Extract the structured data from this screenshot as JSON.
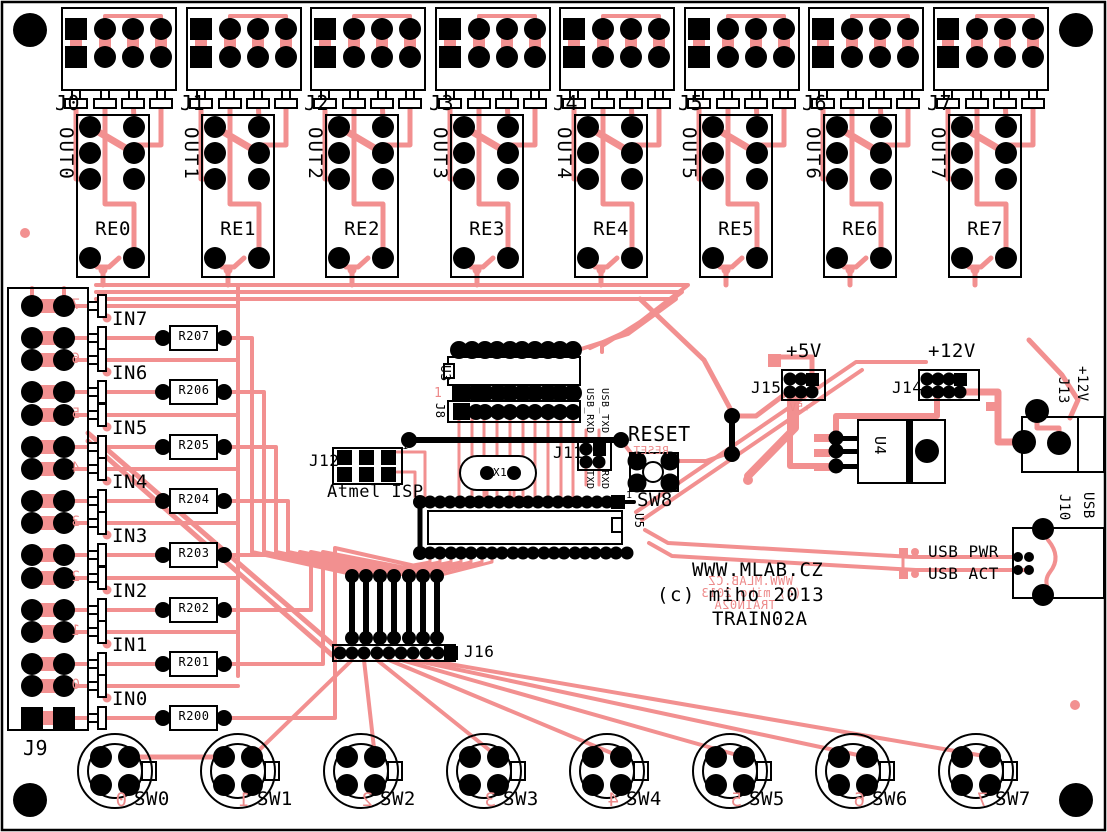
{
  "board": {
    "site": "WWW.MLAB.CZ",
    "copyright": "(c) miho 2013",
    "title": "TRAIN02A",
    "mirror_site": "WWW.MLAB.CZ",
    "mirror_copyright": "(c) miho 2013",
    "mirror_title": "TRAIN02A",
    "colors": {
      "trace_pink": "#F29090",
      "silkscreen_black": "#000000",
      "board_white": "#FFFFFF"
    }
  },
  "output_connectors": [
    {
      "label": "J0"
    },
    {
      "label": "J1"
    },
    {
      "label": "J2"
    },
    {
      "label": "J3"
    },
    {
      "label": "J4"
    },
    {
      "label": "J5"
    },
    {
      "label": "J6"
    },
    {
      "label": "J7"
    }
  ],
  "relays": [
    {
      "label": "RE0",
      "out": "OUT0"
    },
    {
      "label": "RE1",
      "out": "OUT1"
    },
    {
      "label": "RE2",
      "out": "OUT2"
    },
    {
      "label": "RE3",
      "out": "OUT3"
    },
    {
      "label": "RE4",
      "out": "OUT4"
    },
    {
      "label": "RE5",
      "out": "OUT5"
    },
    {
      "label": "RE6",
      "out": "OUT6"
    },
    {
      "label": "RE7",
      "out": "OUT7"
    }
  ],
  "inputs": [
    {
      "label": "IN7",
      "resistor": "R207",
      "pin": "7"
    },
    {
      "label": "IN6",
      "resistor": "R206",
      "pin": "6"
    },
    {
      "label": "IN5",
      "resistor": "R205",
      "pin": "5"
    },
    {
      "label": "IN4",
      "resistor": "R204",
      "pin": "4"
    },
    {
      "label": "IN3",
      "resistor": "R203",
      "pin": "3"
    },
    {
      "label": "IN2",
      "resistor": "R202",
      "pin": "2"
    },
    {
      "label": "IN1",
      "resistor": "R201",
      "pin": "1"
    },
    {
      "label": "IN0",
      "resistor": "R200",
      "pin": "0"
    }
  ],
  "input_connector": {
    "label": "J9"
  },
  "switches": [
    {
      "label": "SW0",
      "pin": "0"
    },
    {
      "label": "SW1",
      "pin": "1"
    },
    {
      "label": "SW2",
      "pin": "2"
    },
    {
      "label": "SW3",
      "pin": "3"
    },
    {
      "label": "SW4",
      "pin": "4"
    },
    {
      "label": "SW5",
      "pin": "5"
    },
    {
      "label": "SW6",
      "pin": "6"
    },
    {
      "label": "SW7",
      "pin": "7"
    }
  ],
  "mcu": {
    "u3": "U3",
    "j8": "J8",
    "u5": "U5",
    "x1": "X1",
    "pin1": "1"
  },
  "isp": {
    "label": "J12",
    "caption": "Atmel ISP",
    "pin1": "1"
  },
  "serial": {
    "label": "J11",
    "usb_rxd": "USB_RXD",
    "usb_txd": "USB_TXD",
    "txd": "TXD",
    "rxd": "RXD"
  },
  "reset": {
    "label": "RESET",
    "mirror": "RESET",
    "sw": "SW8"
  },
  "j16": {
    "label": "J16"
  },
  "power": {
    "plus5": "+5V",
    "plus5_mirror": "+5V",
    "j15": "J15",
    "plus12": "+12V",
    "j14": "J14",
    "j13": "J13",
    "j13_voltage": "+12V",
    "u4": "U4"
  },
  "usb": {
    "j10": "J10",
    "j10_type": "USB",
    "pwr": "USB PWR",
    "act": "USB ACT"
  }
}
